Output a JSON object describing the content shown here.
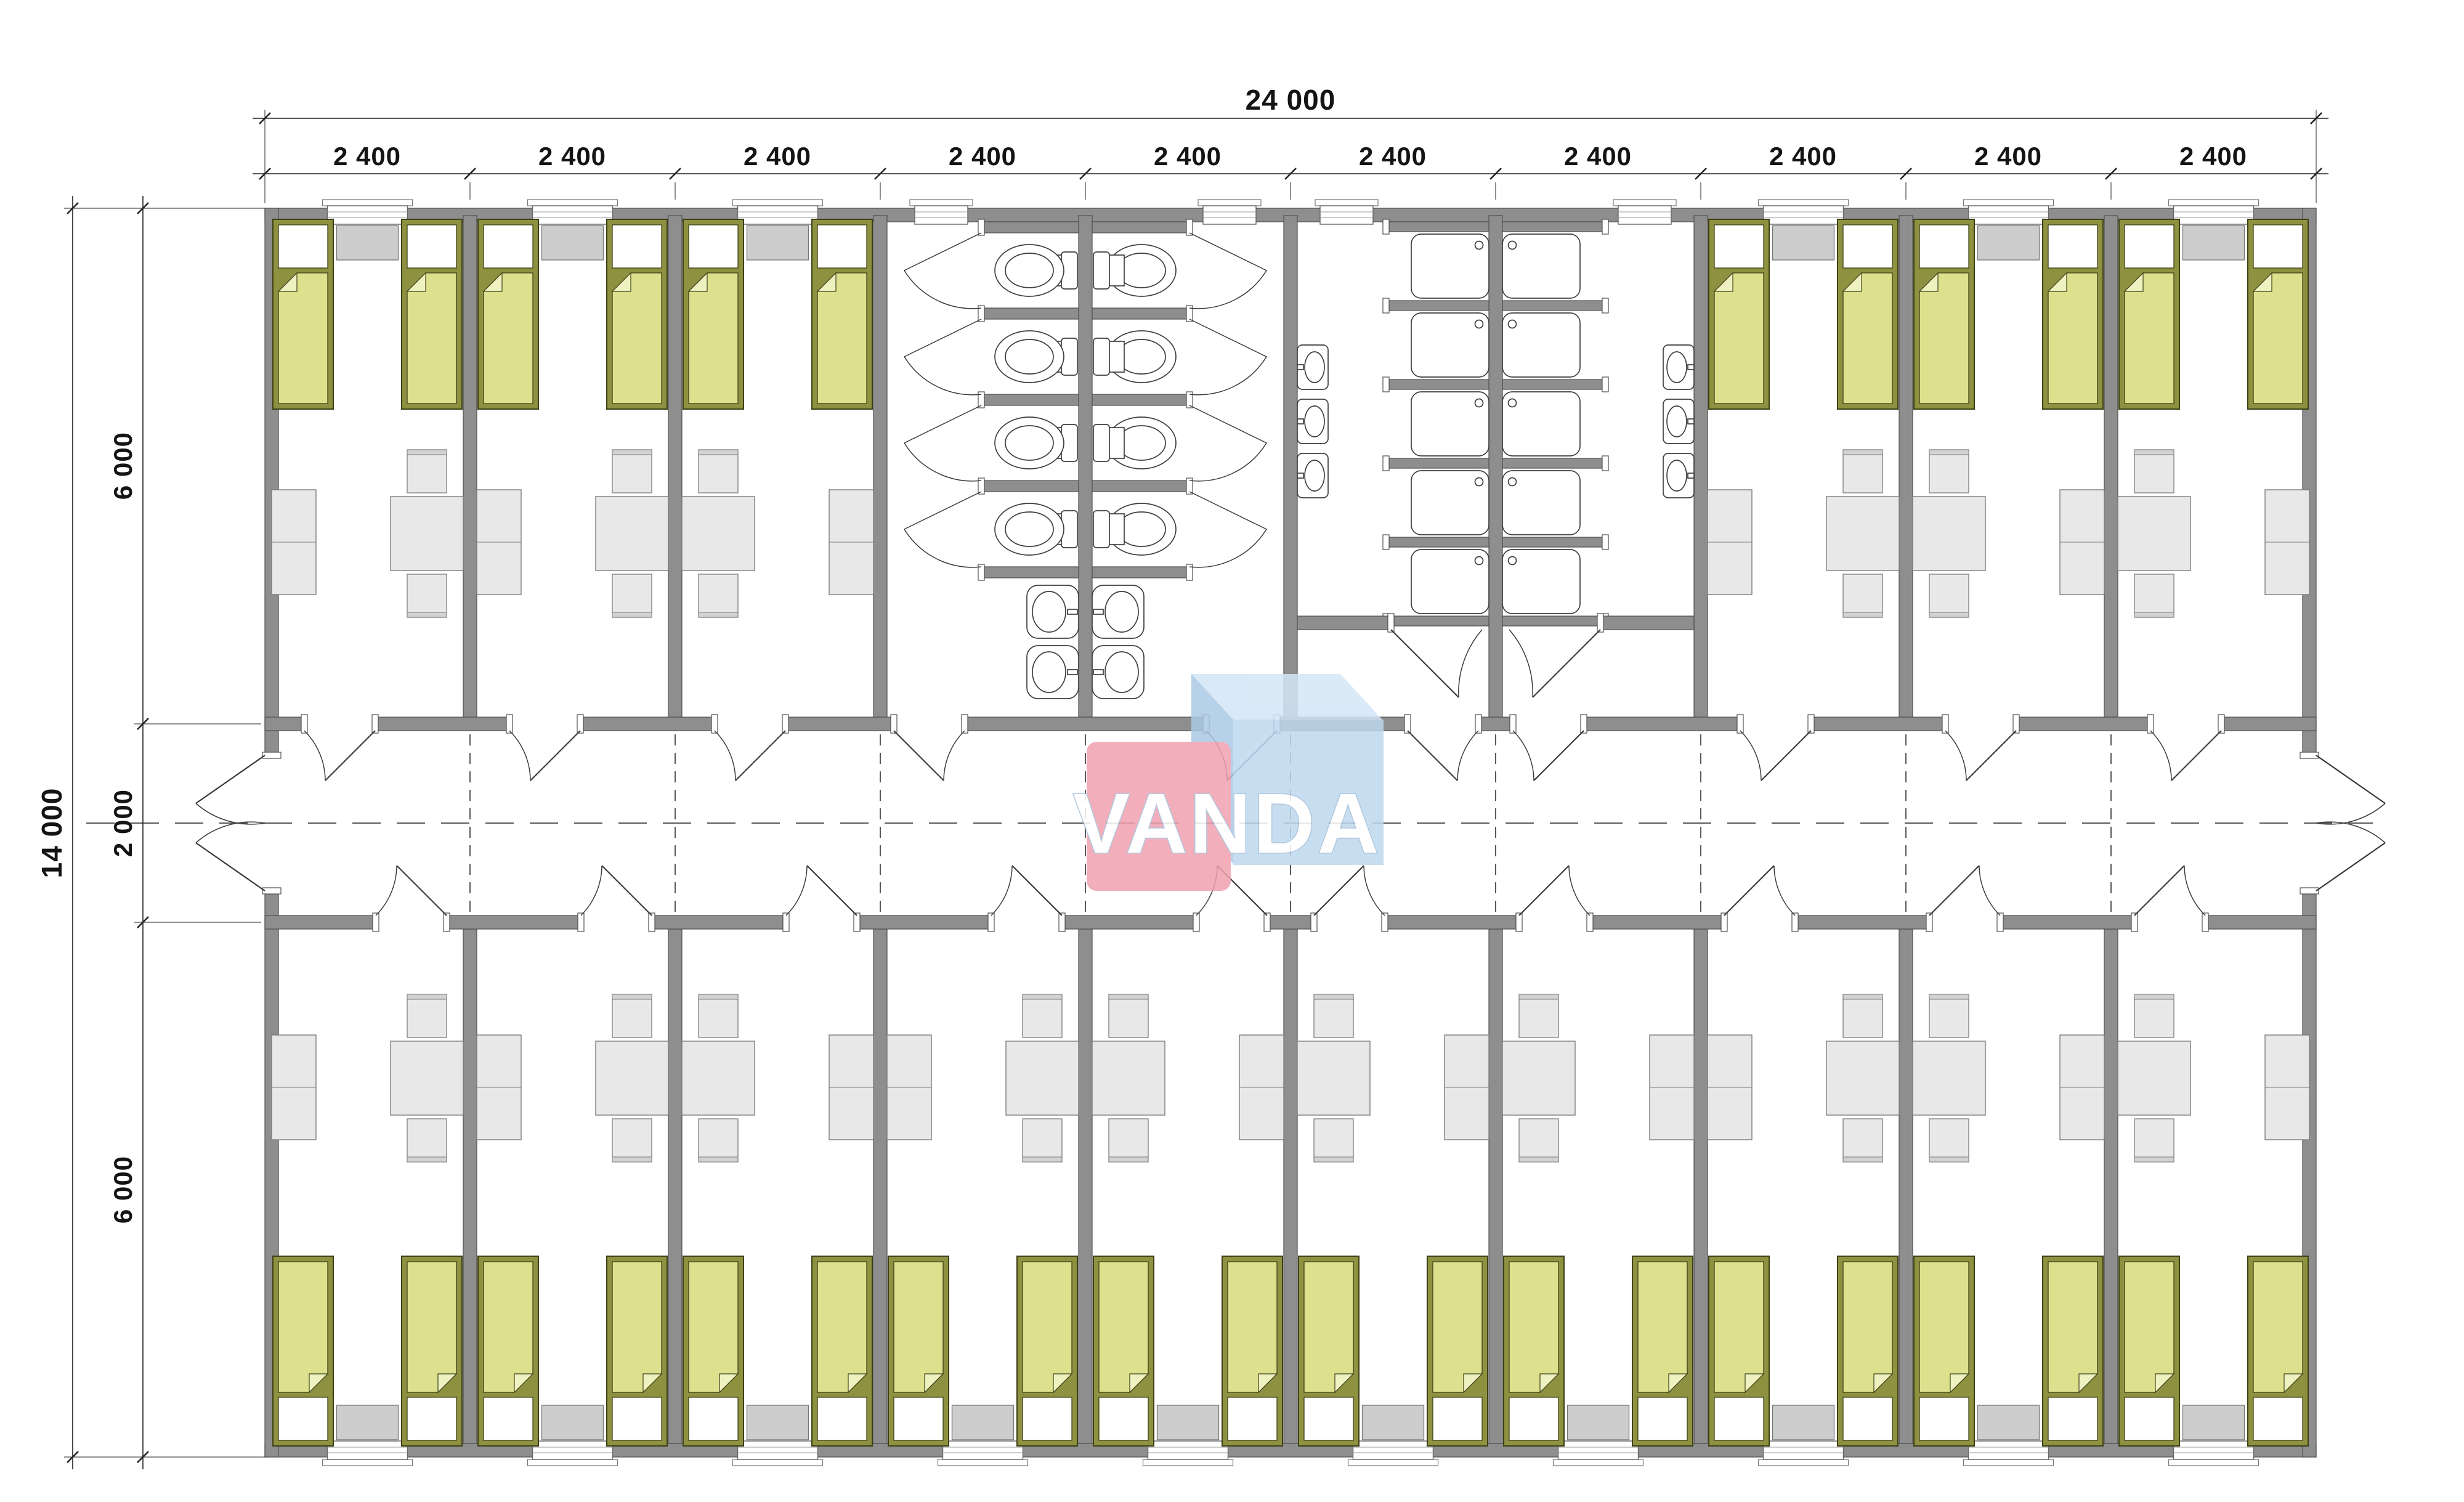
{
  "watermark": {
    "text": "VANDA",
    "pink": "#f0a2b0",
    "blue_front": "#bed9ef",
    "blue_top": "#d3e6f6",
    "blue_side": "#abc9e5"
  },
  "dimensions": {
    "total_width": "24 000",
    "segments": [
      "2 400",
      "2 400",
      "2 400",
      "2 400",
      "2 400",
      "2 400",
      "2 400",
      "2 400",
      "2 400",
      "2 400"
    ],
    "total_depth": "14 000",
    "depth_segments": [
      "6 000",
      "2 000",
      "6 000"
    ]
  },
  "colors": {
    "wall": "#8e8e8e",
    "wall_edge": "#4f4f4f",
    "bed_frame": "#8e9140",
    "bed_frame_edge": "#3e4116",
    "blanket": "#dde08d",
    "blanket_fold": "#eef1c0",
    "pillow": "#ffffff",
    "furniture": "#e8e8e8",
    "furniture_edge": "#7d7d7d",
    "radiator": "#cdcdcd",
    "fixture_line": "#3f3f3f",
    "dash": "#5a5a5a",
    "dim_line": "#222222"
  }
}
